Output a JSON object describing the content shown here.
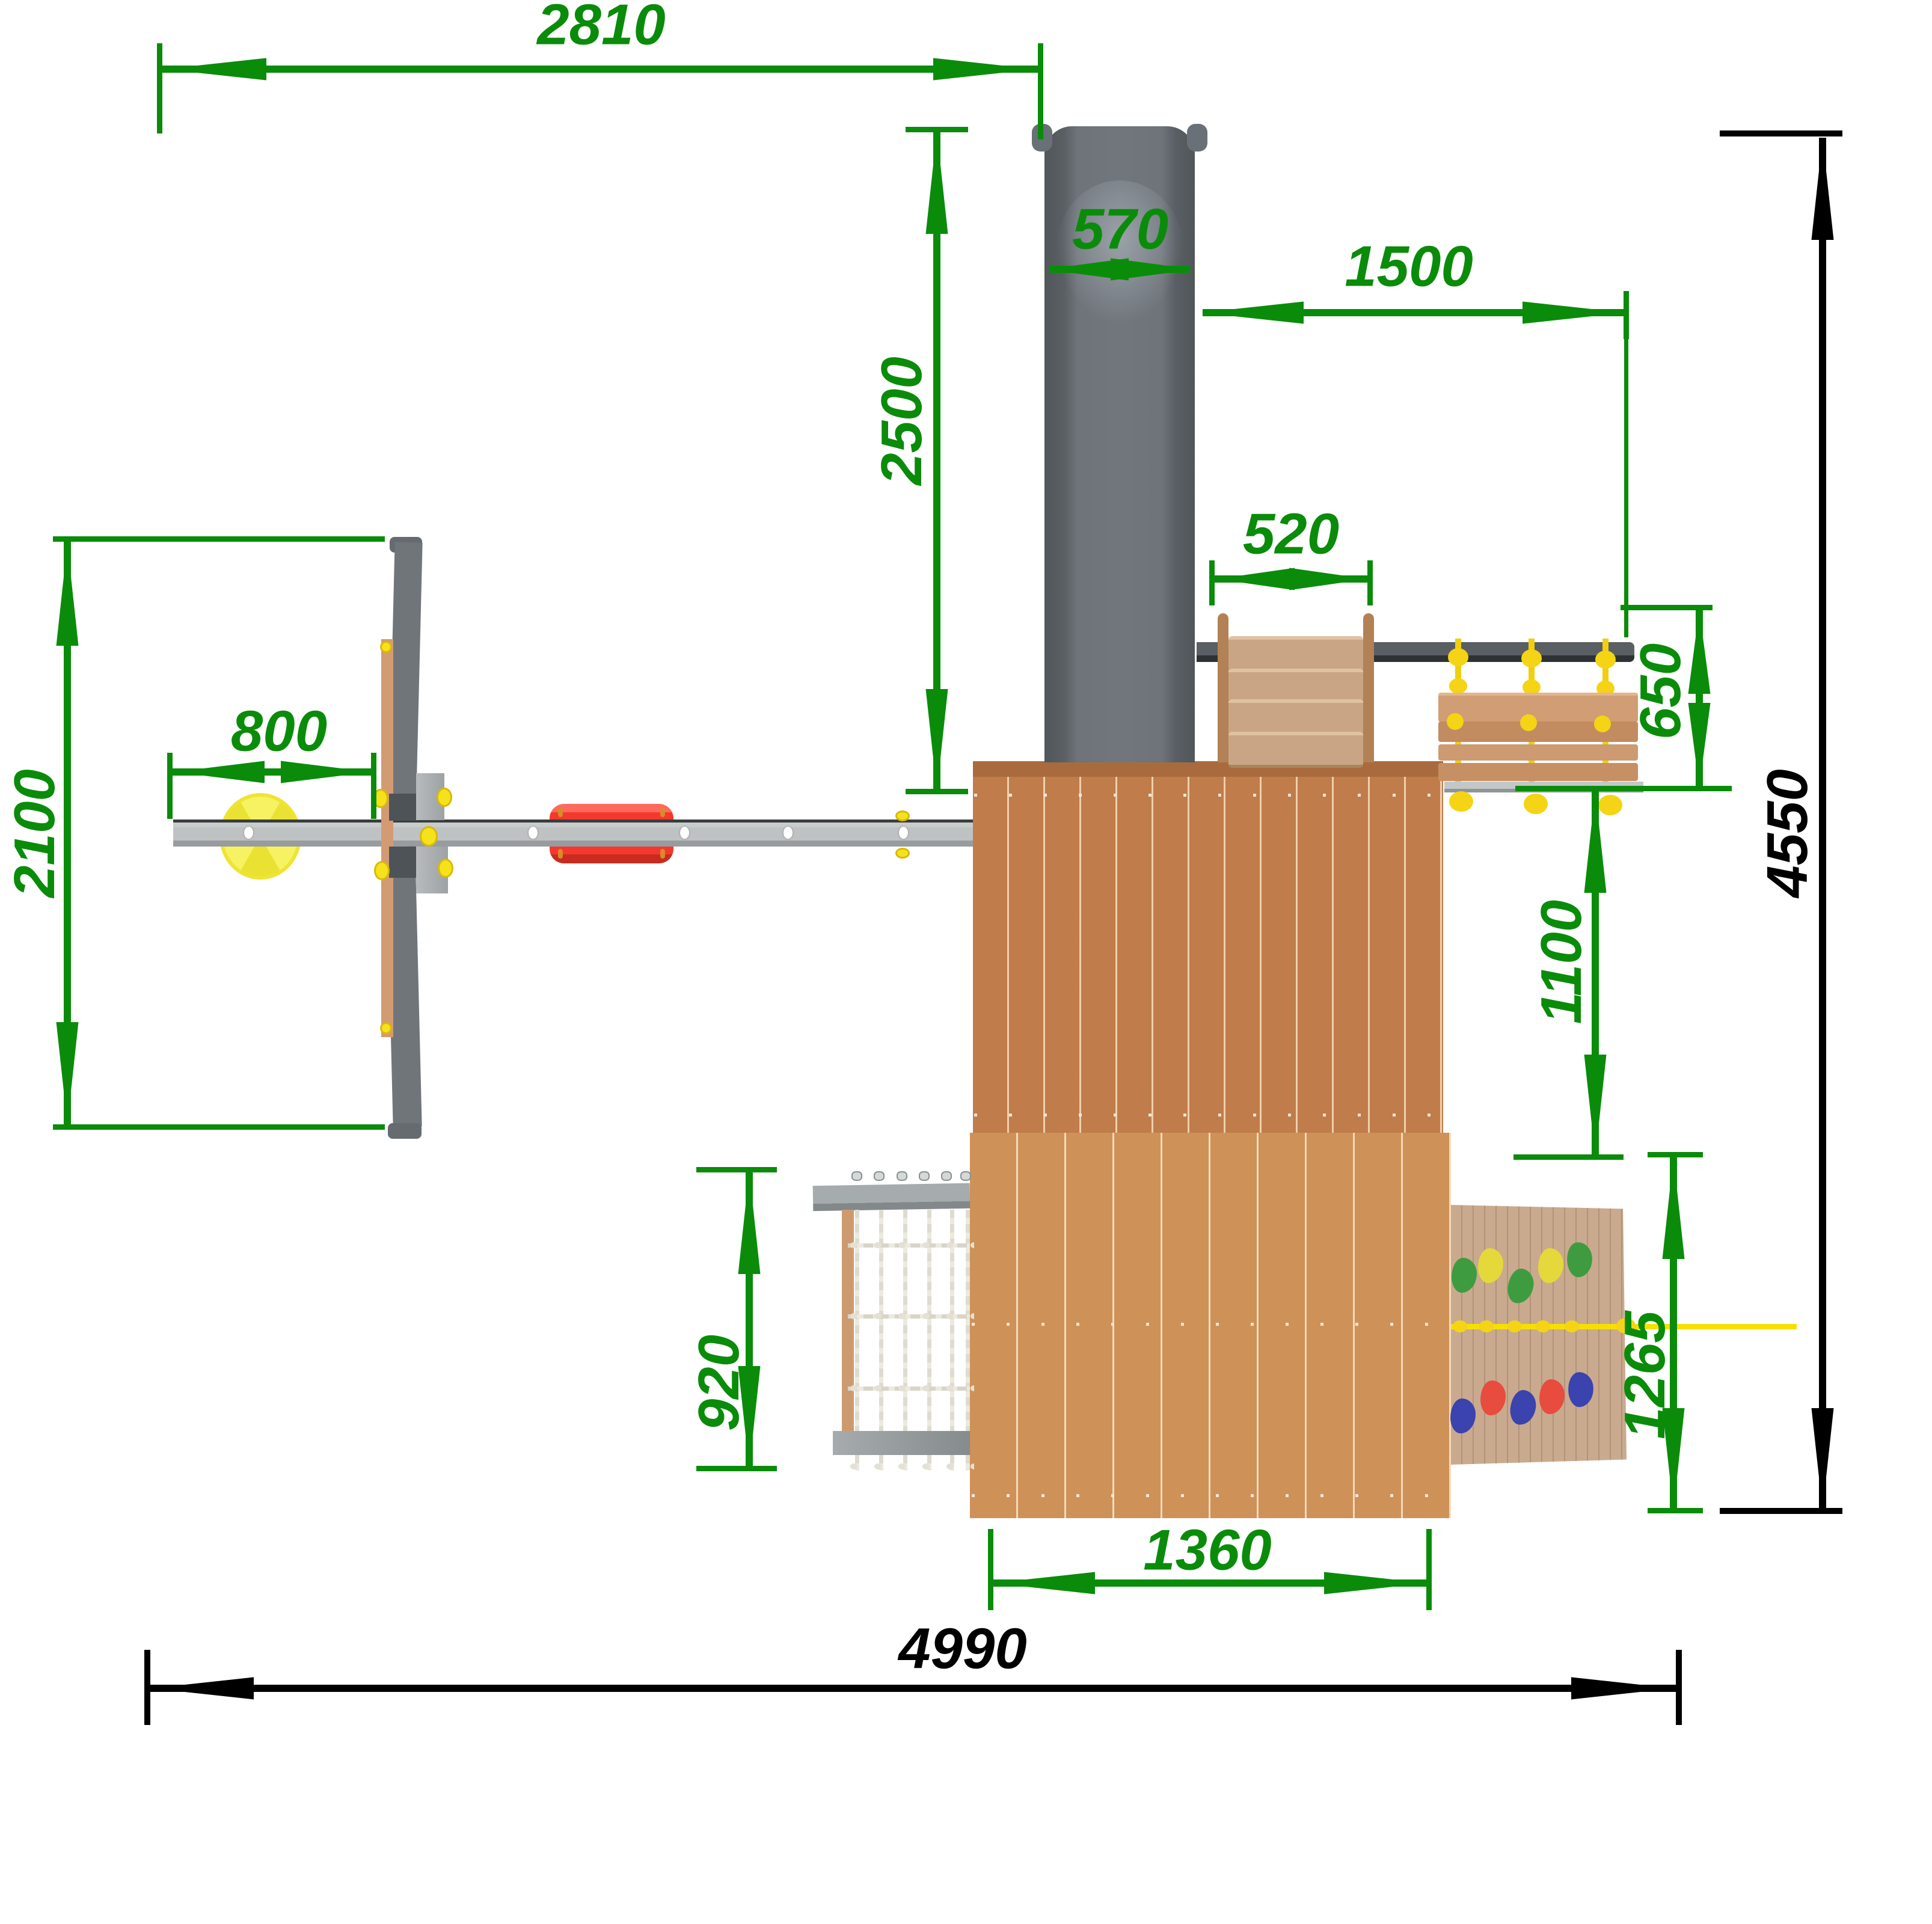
{
  "drawing": {
    "type": "playground-top-view-dimension-drawing",
    "units": "mm",
    "dims": {
      "top_width": "2810",
      "slide_width": "570",
      "rail_length": "1500",
      "slide_length": "2500",
      "ladder_width": "520",
      "bench_depth": "650",
      "swing_offset": "800",
      "swing_depth": "2100",
      "rail_drop": "1100",
      "total_depth": "4550",
      "net_width": "920",
      "wall_drop": "1265",
      "platform_width": "1360",
      "total_width": "4990"
    },
    "colors": {
      "dimension_green": "#0a8c0a",
      "dimension_black": "#000000",
      "slide_gray": "#6e747a",
      "platform_wood_dark": "#c07c4a",
      "platform_wood_light": "#ce9158",
      "beam_gray": "#bfc2c3",
      "rope_yellow": "#f1cf10",
      "disc_yellow": "#f0ea3c",
      "seat_red": "#f5382d",
      "hold_green": "#3f9b40",
      "hold_yellow": "#e5d83a",
      "hold_red": "#e74c3e",
      "hold_blue": "#3a43ae",
      "net_white": "#e4e1d4"
    }
  }
}
